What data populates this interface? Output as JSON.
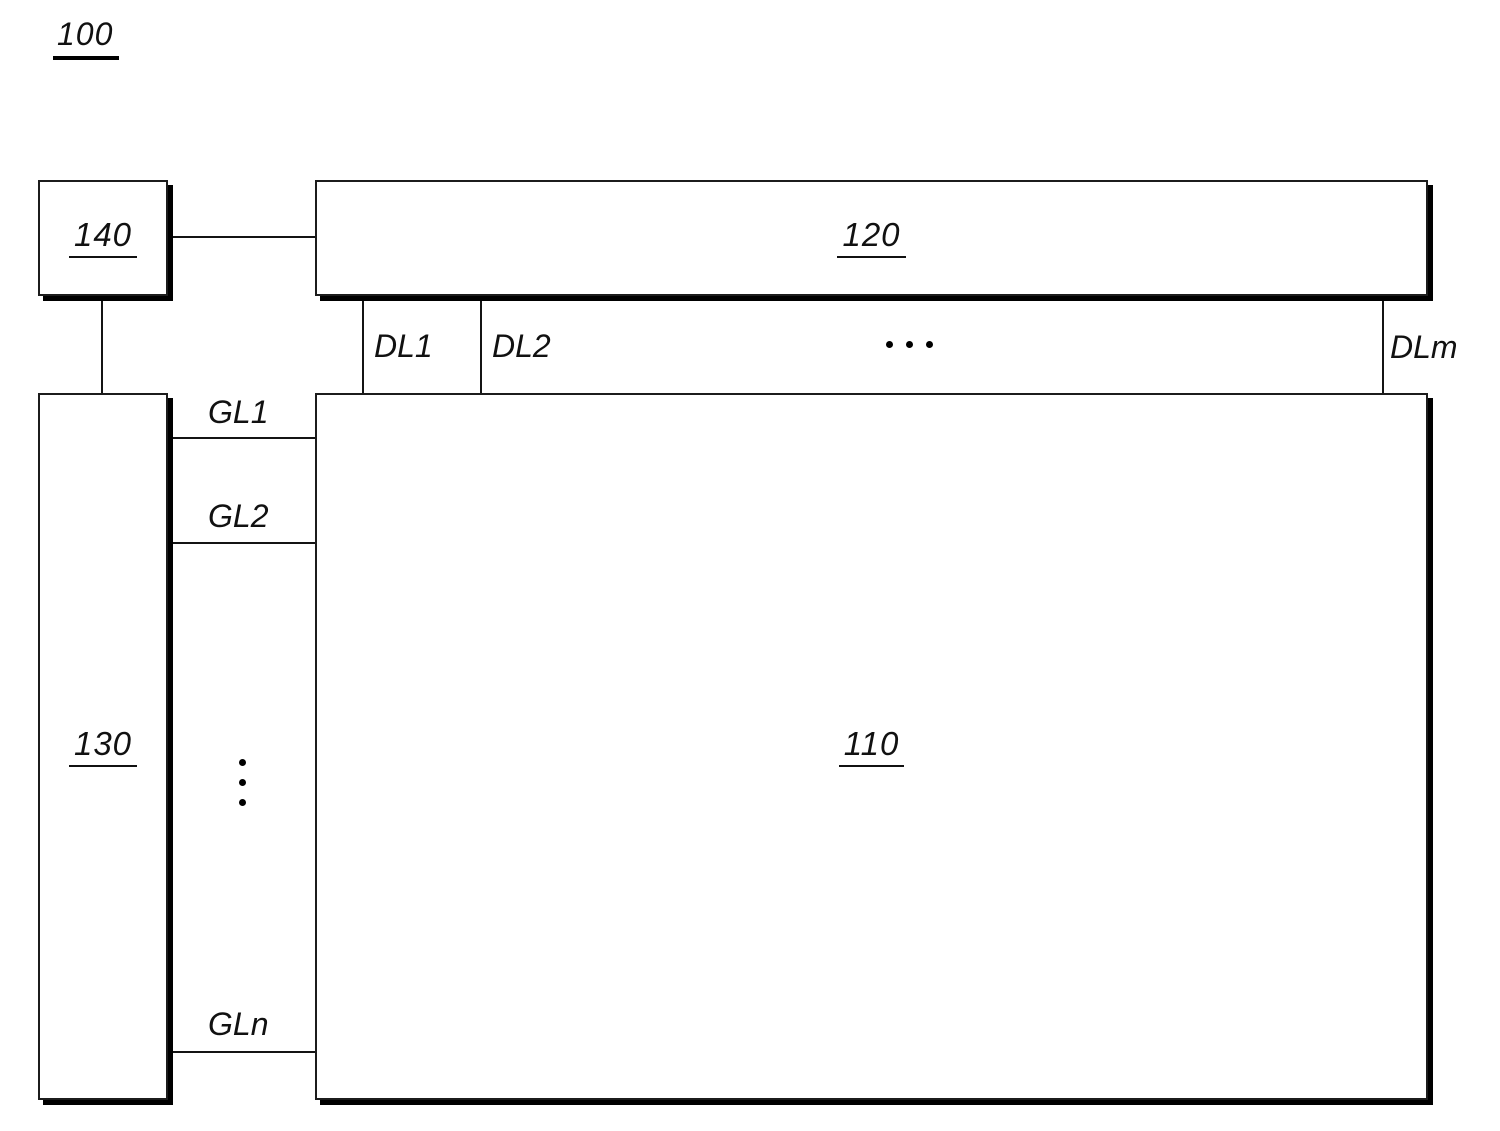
{
  "figure": {
    "reference_label": "100"
  },
  "blocks": {
    "block_110": {
      "label": "110"
    },
    "block_120": {
      "label": "120"
    },
    "block_130": {
      "label": "130"
    },
    "block_140": {
      "label": "140"
    }
  },
  "data_lines": {
    "dl1": "DL1",
    "dl2": "DL2",
    "dlm": "DLm"
  },
  "gate_lines": {
    "gl1": "GL1",
    "gl2": "GL2",
    "gln": "GLn"
  },
  "colors": {
    "ink": "#111111",
    "paper": "#ffffff"
  }
}
